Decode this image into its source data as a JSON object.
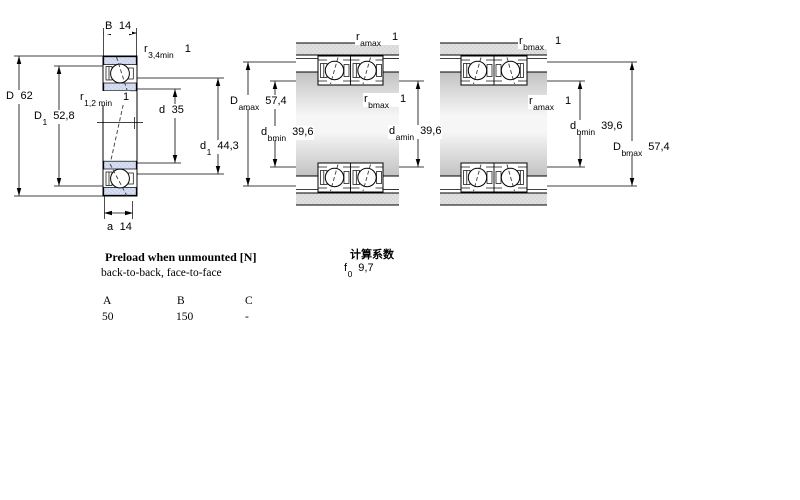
{
  "left_view": {
    "B": {
      "sym": "B",
      "sub": "",
      "val": "14"
    },
    "r34": {
      "sym": "r",
      "sub": "3,4min",
      "val": "1"
    },
    "D": {
      "sym": "D",
      "sub": "",
      "val": "62"
    },
    "D1": {
      "sym": "D",
      "sub": "1",
      "val": "52,8"
    },
    "r12": {
      "sym": "r",
      "sub": "1,2 min",
      "val": "1"
    },
    "d": {
      "sym": "d",
      "sub": "",
      "val": "35"
    },
    "d1": {
      "sym": "d",
      "sub": "1",
      "val": "44,3"
    },
    "a": {
      "sym": "a",
      "sub": "",
      "val": "14"
    }
  },
  "middle_view": {
    "r_amax": {
      "sym": "r",
      "sub": "amax",
      "val": "1"
    },
    "D_amax": {
      "sym": "D",
      "sub": "amax",
      "val": "57,4"
    },
    "d_bmin": {
      "sym": "d",
      "sub": "bmin",
      "val": "39,6"
    },
    "r_bmax": {
      "sym": "r",
      "sub": "bmax",
      "val": "1"
    },
    "d_amin": {
      "sym": "d",
      "sub": "amin",
      "val": "39,6"
    }
  },
  "right_view": {
    "r_bmax": {
      "sym": "r",
      "sub": "bmax",
      "val": "1"
    },
    "r_amax": {
      "sym": "r",
      "sub": "amax",
      "val": "1"
    },
    "d_bmin": {
      "sym": "d",
      "sub": "bmin",
      "val": "39,6"
    },
    "D_bmax": {
      "sym": "D",
      "sub": "bmax",
      "val": "57,4"
    }
  },
  "preload": {
    "title": "Preload when unmounted [N]",
    "subtitle": "back-to-back, face-to-face",
    "headers": [
      "A",
      "B",
      "C"
    ],
    "values": [
      "50",
      "150",
      "-"
    ]
  },
  "calc": {
    "title": "计算系数",
    "f0": {
      "sym": "f",
      "sub": "0",
      "val": "9,7"
    }
  },
  "colors": {
    "ring_fill": "#ccd5ec",
    "housing_fill": "#d8d8d8",
    "shaft_light": "#f6f6f6",
    "shaft_dark": "#c2c2c2",
    "outline": "#000000"
  }
}
